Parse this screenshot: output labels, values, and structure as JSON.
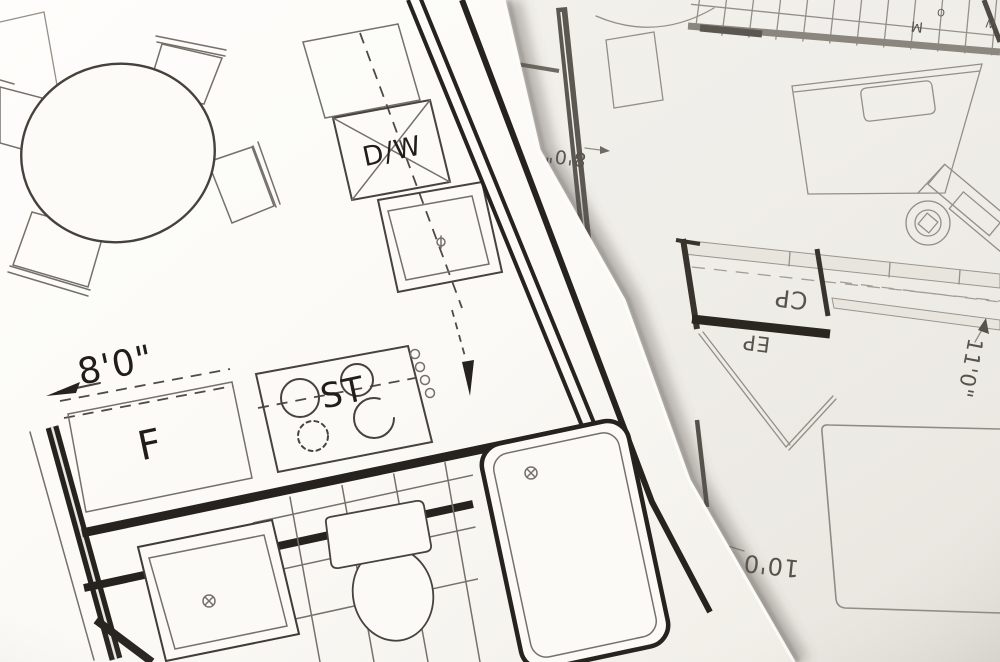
{
  "scene": {
    "title": "Two overlapping architectural floor plan sheets",
    "type": "photograph of blueprint drawings"
  },
  "top_sheet": {
    "name": "kitchen and bathroom floor plan",
    "labels": {
      "dishwasher": "D/W",
      "stove": "ST",
      "refrigerator": "F",
      "dim_kitchen": "8'0\""
    }
  },
  "bottom_sheet": {
    "name": "bedroom floor plan (sheet rotated upside down)",
    "labels": {
      "closet_cp": "CP",
      "closet_ep": "EP",
      "dim_8": "8'0\"",
      "dim_11": "11'0\"",
      "dim_10": "10'0\"",
      "mark_m": "M",
      "mark_o": "O",
      "mark_w": "W"
    }
  },
  "colors": {
    "top_paper": "#fdfcfa",
    "bottom_paper": "#f1efea",
    "ink_bold": "#26231e",
    "ink_thin": "#75716a",
    "ink_under": "#938f87"
  }
}
